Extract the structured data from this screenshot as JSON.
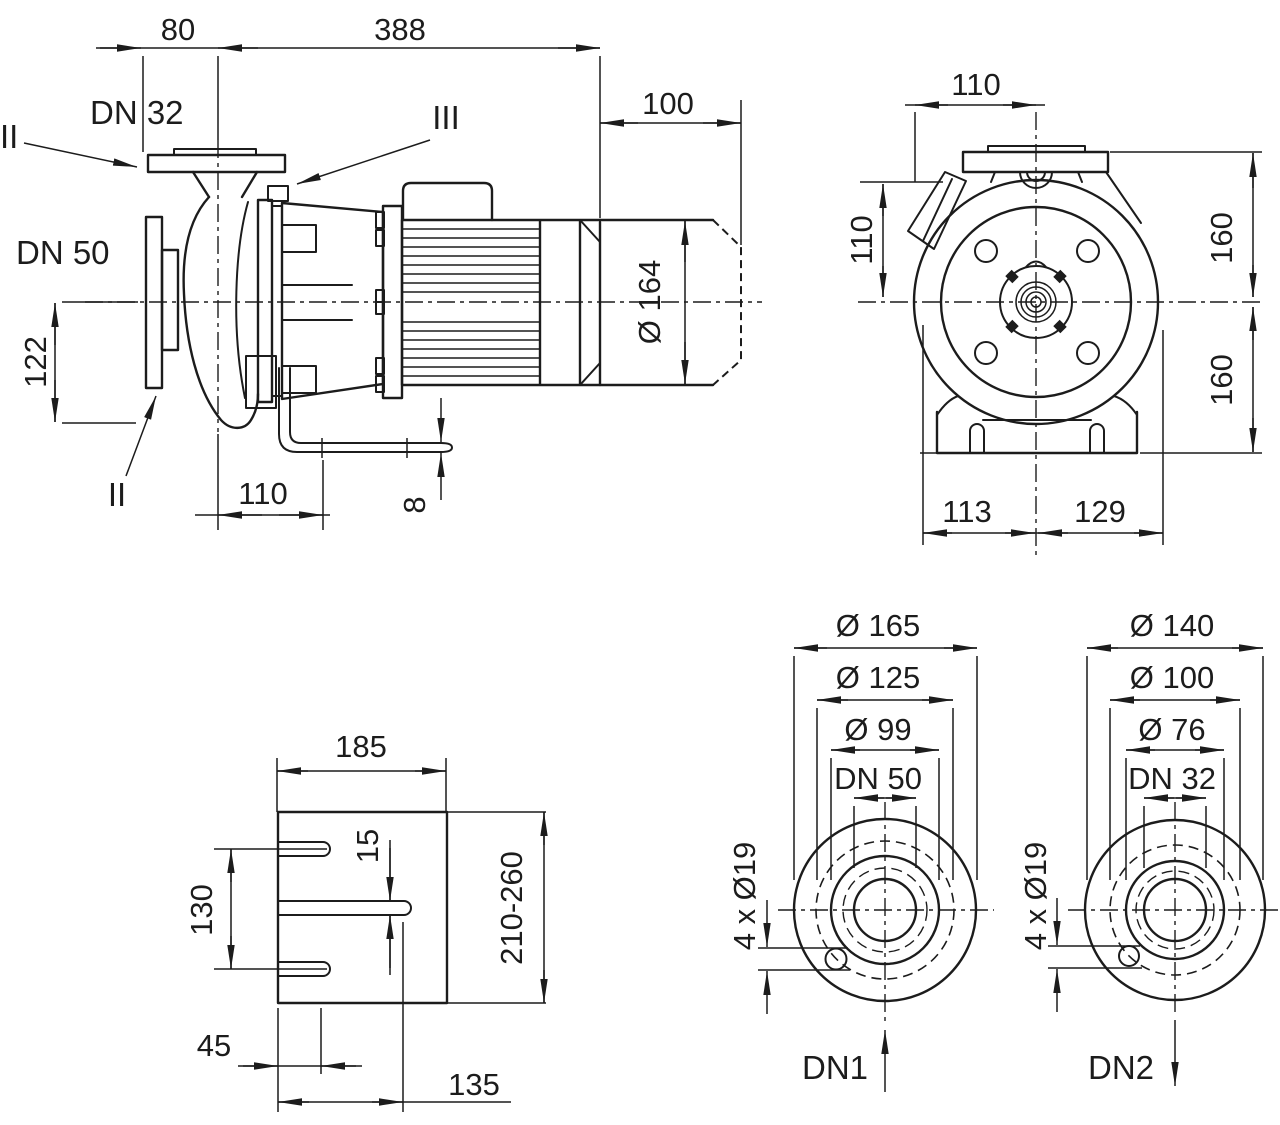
{
  "drawing_type": "pump dimensional drawing",
  "colors": {
    "ink": "#1c1c1c",
    "background": "#ffffff"
  },
  "side_view": {
    "dim_80": "80",
    "dim_388": "388",
    "dim_100": "100",
    "dim_dia_164": "Ø 164",
    "dim_122": "122",
    "dim_110": "110",
    "dim_8": "8",
    "label_dn32": "DN 32",
    "label_dn50": "DN 50",
    "mark_flange": "II",
    "mark_vent": "III",
    "mark_drain": "II"
  },
  "front_view": {
    "dim_110_top": "110",
    "dim_110_left": "110",
    "dim_160_upper": "160",
    "dim_160_lower": "160",
    "dim_113": "113",
    "dim_129": "129"
  },
  "base_view": {
    "dim_185": "185",
    "dim_15": "15",
    "dim_130": "130",
    "dim_210_260": "210-260",
    "dim_45": "45",
    "dim_135": "135"
  },
  "flange_dn50_view": {
    "dim_outer": "Ø 165",
    "dim_bolt_circle": "Ø 125",
    "dim_face": "Ø 99",
    "dim_bore": "DN 50",
    "dim_bolt_holes": "4 x Ø19",
    "port_label": "DN1"
  },
  "flange_dn32_view": {
    "dim_outer": "Ø 140",
    "dim_bolt_circle": "Ø 100",
    "dim_face": "Ø 76",
    "dim_bore": "DN 32",
    "dim_bolt_holes": "4 x Ø19",
    "port_label": "DN2"
  }
}
